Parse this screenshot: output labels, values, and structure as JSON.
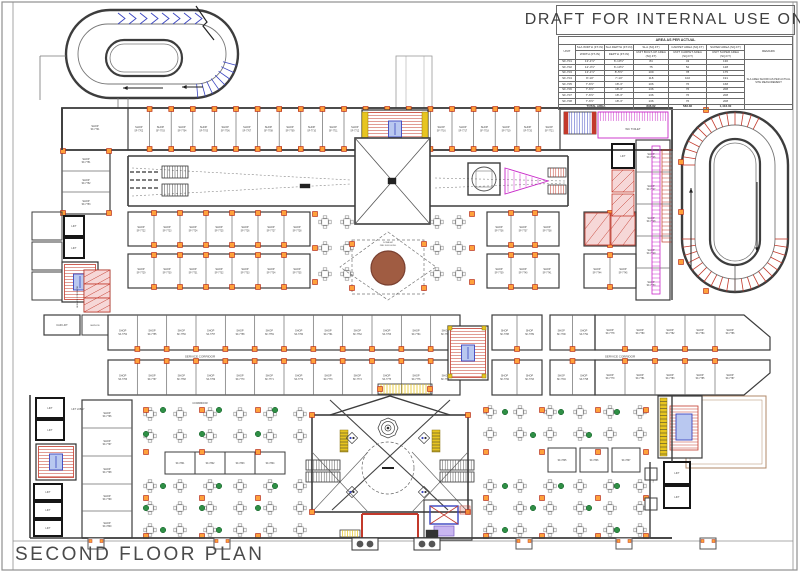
{
  "header": {
    "text": "DRAFT FOR INTERNAL USE ONLY"
  },
  "title": {
    "text": "SECOND FLOOR PLAN"
  },
  "area_table": {
    "caption": "AREA AS PER ACTUAL",
    "col_headers_row1": [
      "UNIT",
      "SLA WIDTH (FT-IN)",
      "SLA DEPTH (FT-IN)",
      "SLA (SQ.FT)",
      "CARPET AREA (SQ.FT)",
      "SUPER AREA (SQ.FT)",
      "REMARK"
    ],
    "col_headers_row2": [
      "WIDTH (FT-IN)",
      "DEPTH (FT-IN)",
      "UNIT BUILT-UP AREA (SQ.FT)",
      "UNIT CARPET AREA (SQ.FT)",
      "UNIT SUPER AREA (SQ.FT)"
    ],
    "rows": [
      [
        "SF-701",
        "13'-1½\"",
        "6'-10½\"",
        "84",
        "43",
        "130"
      ],
      [
        "SF-702",
        "12'-4½\"",
        "6'-10½\"",
        "75",
        "52",
        "128"
      ],
      [
        "SF-703",
        "13'-1½\"",
        "8'-5½\"",
        "109",
        "78",
        "175"
      ],
      [
        "SF-704",
        "8'-10\"",
        "7'-10\"",
        "118",
        "102",
        "191"
      ],
      [
        "SF-705",
        "7'-6½\"",
        "18'-3\"",
        "106",
        "76",
        "168"
      ],
      [
        "SF-706",
        "7'-6½\"",
        "18'-3\"",
        "136",
        "76",
        "208"
      ],
      [
        "SF-707",
        "7'-6½\"",
        "18'-3\"",
        "136",
        "76",
        "208"
      ],
      [
        "SF-708",
        "7'-6½\"",
        "18'-3\"",
        "136",
        "76",
        "208"
      ]
    ],
    "total_label": "TOTAL AREA",
    "totals": [
      "896.82",
      "583.36",
      "1,416.00"
    ],
    "remark": "SLA AREA SHOWN AS PER ACTUAL SITE MEASUREMENT"
  },
  "labels": {
    "shop": "SHOP",
    "shop_prefix": "SF-7",
    "lift": "LIFT",
    "lift_lobby": "LIFT LOBBY",
    "car_lift": "CAR LIFT",
    "wc_toilet": "WC TOILET",
    "service": "SERVICE",
    "service_corridor": "SERVICE CORRIDOR",
    "corridor": "CORRIDOR",
    "dome_line1": "DOME AT",
    "dome_line2": "2ND FLR LEVEL"
  },
  "colors": {
    "wall": "#3d3d3d",
    "partition": "#6b6b6b",
    "text": "#3f3f3f",
    "column_fill": "#ffa13a",
    "column_stroke": "#c03a1d",
    "red": "#c3392b",
    "blue": "#3a45c0",
    "magenta": "#c929c9",
    "green": "#2f8f45",
    "brown_fill": "#a05c42",
    "brown_edge": "#7a4030",
    "yellow": "#e7c520",
    "lightblue": "#b9c8f0",
    "pink": "#f6d7d7",
    "furniture": "#8d8d8d",
    "frame": "#8f8f8f",
    "terrace": "#b08968"
  }
}
